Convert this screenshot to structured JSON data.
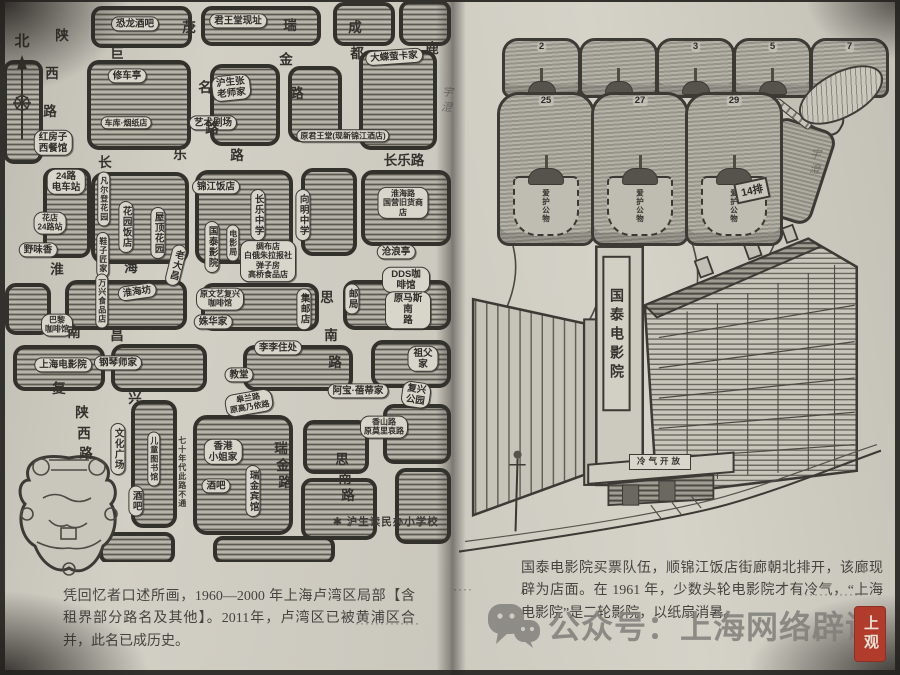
{
  "book": {
    "left_page": {
      "compass": "北",
      "caption": "凭回忆者口述所画，1960—2000 年上海卢湾区局部【含租界部分路名及其他】。2011年，卢湾区已被黄浦区合并，此名已成历史。",
      "footnote": "✱ 沪生读民办小学校",
      "signature": "宇澄",
      "dots": "·············",
      "map_labels": [
        {
          "t": "恐龙酒吧",
          "x": 130,
          "y": 22
        },
        {
          "t": "君王堂现址",
          "x": 233,
          "y": 19
        },
        {
          "t": "修车亭",
          "x": 122,
          "y": 74
        },
        {
          "t": "车库·烟纸店",
          "x": 121,
          "y": 121,
          "s": 1
        },
        {
          "t": "沪生张\n老师家",
          "x": 226,
          "y": 86,
          "r": -6
        },
        {
          "t": "艺术剧场",
          "x": 208,
          "y": 121
        },
        {
          "t": "大蝶萤卡家",
          "x": 389,
          "y": 55,
          "r": -4
        },
        {
          "t": "原君王堂(现新锦江酒店)",
          "x": 338,
          "y": 134,
          "s": 1
        },
        {
          "t": "红房子\n西餐馆",
          "x": 48,
          "y": 141
        },
        {
          "t": "24路\n电车站",
          "x": 61,
          "y": 180
        },
        {
          "t": "花店\n24路站",
          "x": 45,
          "y": 221,
          "s": 1
        },
        {
          "t": "野味香",
          "x": 33,
          "y": 248
        },
        {
          "t": "凡尔登花园",
          "x": 99,
          "y": 197,
          "v": 1,
          "s": 1
        },
        {
          "t": "花园饭店",
          "x": 121,
          "y": 225,
          "v": 1
        },
        {
          "t": "鞋子匠家",
          "x": 98,
          "y": 253,
          "v": 1,
          "s": 1
        },
        {
          "t": "屋顶花园",
          "x": 153,
          "y": 231,
          "v": 1
        },
        {
          "t": "锦江饭店",
          "x": 211,
          "y": 185
        },
        {
          "t": "长乐中学",
          "x": 253,
          "y": 213,
          "v": 1
        },
        {
          "t": "国泰影院",
          "x": 207,
          "y": 245,
          "v": 1
        },
        {
          "t": "电影局",
          "x": 228,
          "y": 241,
          "v": 1,
          "s": 1
        },
        {
          "t": "向明中学",
          "x": 298,
          "y": 213,
          "v": 1
        },
        {
          "t": "淮海路\n国营旧货商店",
          "x": 398,
          "y": 201,
          "s": 1
        },
        {
          "t": "绸布店\n白俄朱拉报社\n弹子房\n高桥食品店",
          "x": 263,
          "y": 259,
          "s": 1
        },
        {
          "t": "老大昌",
          "x": 171,
          "y": 263,
          "v": 1,
          "r": 14
        },
        {
          "t": "淮海坊",
          "x": 132,
          "y": 290,
          "r": -8
        },
        {
          "t": "原文艺复兴\n咖啡馆",
          "x": 215,
          "y": 297,
          "s": 1
        },
        {
          "t": "姝华家",
          "x": 208,
          "y": 320
        },
        {
          "t": "万兴食品店",
          "x": 97,
          "y": 299,
          "v": 1,
          "s": 1
        },
        {
          "t": "巴黎\n咖啡馆",
          "x": 52,
          "y": 323,
          "s": 1
        },
        {
          "t": "集邮店",
          "x": 299,
          "y": 307,
          "v": 1
        },
        {
          "t": "邮局",
          "x": 347,
          "y": 297,
          "v": 1
        },
        {
          "t": "沧浪亭",
          "x": 391,
          "y": 250
        },
        {
          "t": "DDS咖啡馆",
          "x": 401,
          "y": 278
        },
        {
          "t": "原马斯南\n路",
          "x": 403,
          "y": 308
        },
        {
          "t": "李李住处",
          "x": 273,
          "y": 346
        },
        {
          "t": "祖父家",
          "x": 418,
          "y": 357
        },
        {
          "t": "教堂",
          "x": 234,
          "y": 373
        },
        {
          "t": "上海电影院",
          "x": 58,
          "y": 363
        },
        {
          "t": "钢琴师家",
          "x": 113,
          "y": 361
        },
        {
          "t": "阿宝·蓓蒂家",
          "x": 353,
          "y": 389
        },
        {
          "t": "复兴\n公园",
          "x": 411,
          "y": 393,
          "r": 8
        },
        {
          "t": "皋兰路\n原高乃依路",
          "x": 244,
          "y": 401,
          "r": -10,
          "s": 1
        },
        {
          "t": "香山路\n原莫里哀路",
          "x": 379,
          "y": 425,
          "s": 1
        },
        {
          "t": "香港\n小姐家",
          "x": 218,
          "y": 450
        },
        {
          "t": "酒吧",
          "x": 211,
          "y": 484
        },
        {
          "t": "瑞金宾馆",
          "x": 248,
          "y": 489,
          "v": 1
        },
        {
          "t": "儿童图书馆",
          "x": 149,
          "y": 457,
          "v": 1,
          "s": 1
        },
        {
          "t": "酒吧",
          "x": 131,
          "y": 499,
          "v": 1
        },
        {
          "t": "文化广场",
          "x": 113,
          "y": 447,
          "v": 1
        },
        {
          "t": "七十年代此路不通",
          "x": 177,
          "y": 470,
          "v": 1,
          "k": "note",
          "s": 1
        },
        {
          "t": "陕",
          "x": 57,
          "y": 34,
          "k": "st"
        },
        {
          "t": "西",
          "x": 47,
          "y": 72,
          "k": "st"
        },
        {
          "t": "路",
          "x": 45,
          "y": 110,
          "k": "st"
        },
        {
          "t": "巨",
          "x": 112,
          "y": 52,
          "k": "st"
        },
        {
          "t": "鹿",
          "x": 427,
          "y": 47,
          "k": "st"
        },
        {
          "t": "茂",
          "x": 184,
          "y": 26,
          "k": "st"
        },
        {
          "t": "名",
          "x": 200,
          "y": 86,
          "k": "st"
        },
        {
          "t": "路",
          "x": 207,
          "y": 127,
          "k": "st"
        },
        {
          "t": "瑞",
          "x": 285,
          "y": 24,
          "k": "st"
        },
        {
          "t": "金",
          "x": 281,
          "y": 58,
          "k": "st"
        },
        {
          "t": "路",
          "x": 292,
          "y": 92,
          "k": "st"
        },
        {
          "t": "成",
          "x": 350,
          "y": 26,
          "k": "st"
        },
        {
          "t": "都",
          "x": 352,
          "y": 52,
          "k": "st"
        },
        {
          "t": "长",
          "x": 100,
          "y": 161,
          "k": "st"
        },
        {
          "t": "乐",
          "x": 175,
          "y": 153,
          "k": "st"
        },
        {
          "t": "路",
          "x": 232,
          "y": 154,
          "k": "st"
        },
        {
          "t": "长乐路",
          "x": 399,
          "y": 159,
          "k": "st"
        },
        {
          "t": "淮",
          "x": 52,
          "y": 268,
          "k": "st"
        },
        {
          "t": "海",
          "x": 126,
          "y": 266,
          "k": "st"
        },
        {
          "t": "南",
          "x": 69,
          "y": 331,
          "k": "st"
        },
        {
          "t": "昌",
          "x": 112,
          "y": 334,
          "k": "st"
        },
        {
          "t": "思",
          "x": 322,
          "y": 296,
          "k": "st"
        },
        {
          "t": "南",
          "x": 326,
          "y": 334,
          "k": "st"
        },
        {
          "t": "路",
          "x": 330,
          "y": 361,
          "k": "st"
        },
        {
          "t": "复",
          "x": 54,
          "y": 387,
          "k": "st"
        },
        {
          "t": "兴",
          "x": 130,
          "y": 397,
          "k": "st"
        },
        {
          "t": "陕",
          "x": 77,
          "y": 411,
          "k": "st"
        },
        {
          "t": "西",
          "x": 79,
          "y": 432,
          "k": "st"
        },
        {
          "t": "路",
          "x": 81,
          "y": 452,
          "k": "st"
        },
        {
          "t": "瑞",
          "x": 276,
          "y": 447,
          "k": "st"
        },
        {
          "t": "金",
          "x": 278,
          "y": 464,
          "k": "st"
        },
        {
          "t": "路",
          "x": 280,
          "y": 481,
          "k": "st"
        },
        {
          "t": "思",
          "x": 337,
          "y": 458,
          "k": "st"
        },
        {
          "t": "南",
          "x": 340,
          "y": 477,
          "k": "st"
        },
        {
          "t": "路",
          "x": 343,
          "y": 494,
          "k": "st"
        }
      ]
    },
    "right_page": {
      "caption": "国泰电影院买票队伍，顺锦江饭店街廊朝北排开，该廊现辟为店面。在 1961 年，少数头轮电影院才有冷气，“上海电影院”是二轮影院，以纸扇消暑。",
      "seats": {
        "back_row": [
          "2",
          "",
          "3",
          "5",
          "7"
        ],
        "front_row": [
          "25",
          "27",
          "29"
        ],
        "pocket_text": "爱护公物",
        "row_label": "14排"
      },
      "building": {
        "tower_sign": "国泰电影院",
        "entrance_sign": "冷气开放"
      },
      "signature": "宇澄",
      "dots_left": "····",
      "dots_right": "·············"
    },
    "watermark": {
      "account_label": "公众号：上海网络辟谣"
    },
    "seal": "上观"
  }
}
